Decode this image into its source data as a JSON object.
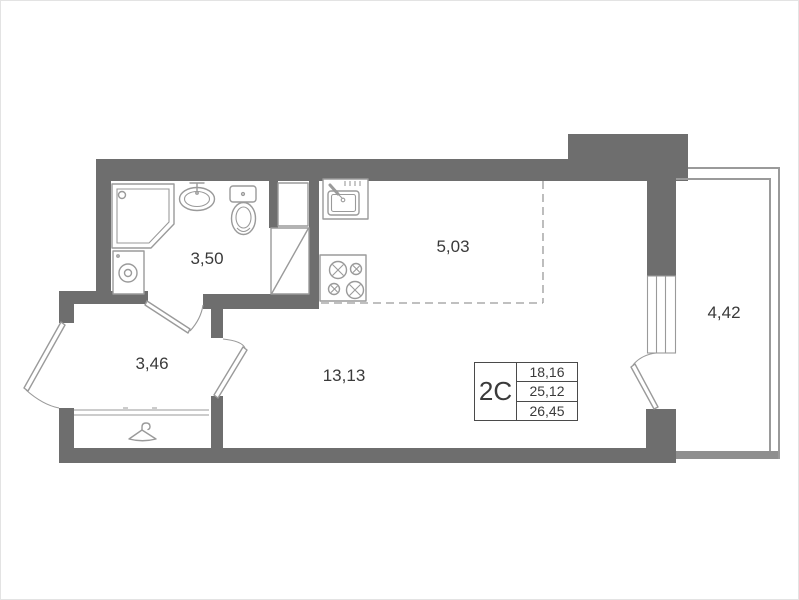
{
  "plan": {
    "title": "Studio apartment floor plan",
    "rooms": [
      {
        "id": "bathroom",
        "area": "3,50"
      },
      {
        "id": "kitchen",
        "area": "5,03"
      },
      {
        "id": "hallway",
        "area": "3,46"
      },
      {
        "id": "living-room",
        "area": "13,13"
      },
      {
        "id": "balcony",
        "area": "4,42"
      }
    ],
    "area_table": {
      "type_label": "2C",
      "rows": [
        "18,16",
        "25,12",
        "26,45"
      ]
    },
    "icons": {
      "shower-icon": "pentagon tray with head dot",
      "washing-machine-icon": "square with drum circle",
      "bath-sink-icon": "oval basin with mixer tap",
      "toilet-icon": "tank and bowl",
      "kitchen-sink-icon": "counter with basin, tap and drainer",
      "stove-icon": "four burner rings",
      "hanger-icon": "clothes hanger",
      "door-arc-icon": "door leaf with swing arc",
      "window-icon": "triple glazing lines",
      "vent-shaft-icon": "rectangle with diagonal"
    },
    "colors": {
      "wall": "#6e6e6e",
      "balcony_wall": "#8f8f8f",
      "line": "#9a9a9a",
      "fixture": "#9a9a9a",
      "text": "#3a3a3a",
      "background": "#ffffff",
      "table_border": "#4a4a4a"
    }
  }
}
